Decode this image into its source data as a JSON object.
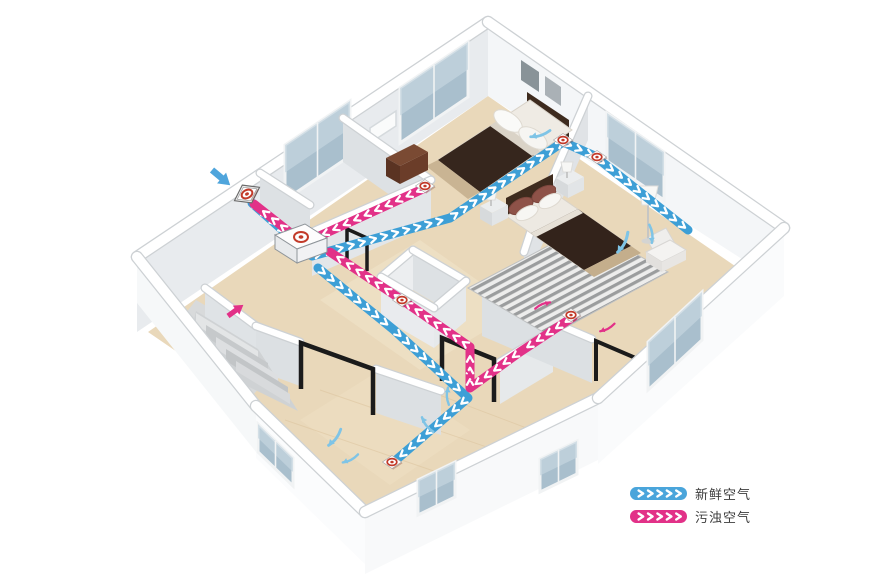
{
  "legend": {
    "items": [
      {
        "id": "fresh-air",
        "label": "新鲜空气",
        "color": "#4AA5DB"
      },
      {
        "id": "stale-air",
        "label": "污浊空气",
        "color": "#E23188"
      }
    ]
  },
  "diagram": {
    "colors": {
      "fresh": "#3D9FD6",
      "stale": "#E23188",
      "room_air": "#7FC4E6",
      "vent_red": "#C23B2A"
    },
    "unit": {
      "id": "heat-recovery-unit",
      "x": 297,
      "y": 245
    },
    "ducts": [
      {
        "id": "duct-fresh-intake",
        "type": "fresh",
        "points": [
          [
            252,
            203
          ],
          [
            297,
            243
          ]
        ]
      },
      {
        "id": "duct-fresh-trunk-bedrooms",
        "type": "fresh",
        "points": [
          [
            312,
            256
          ],
          [
            450,
            218
          ],
          [
            563,
            142
          ]
        ]
      },
      {
        "id": "duct-fresh-bed1-to-bed2",
        "type": "fresh",
        "points": [
          [
            563,
            142
          ],
          [
            597,
            157
          ]
        ]
      },
      {
        "id": "duct-fresh-bedroom2-run",
        "type": "fresh",
        "points": [
          [
            597,
            158
          ],
          [
            688,
            230
          ]
        ]
      },
      {
        "id": "duct-fresh-living-run",
        "type": "fresh",
        "points": [
          [
            318,
            268
          ],
          [
            394,
            330
          ],
          [
            468,
            398
          ],
          [
            396,
            460
          ]
        ]
      },
      {
        "id": "duct-stale-to-outside",
        "type": "stale",
        "points": [
          [
            297,
            238
          ],
          [
            254,
            204
          ]
        ]
      },
      {
        "id": "duct-stale-bedroom1-run",
        "type": "stale",
        "points": [
          [
            425,
            188
          ],
          [
            315,
            238
          ]
        ]
      },
      {
        "id": "duct-stale-trunk",
        "type": "stale",
        "points": [
          [
            573,
            317
          ],
          [
            520,
            352
          ],
          [
            470,
            388
          ],
          [
            470,
            347
          ],
          [
            402,
            300
          ],
          [
            330,
            252
          ]
        ]
      }
    ],
    "vents": [
      {
        "id": "outdoor-wall-vent",
        "x": 247,
        "y": 194,
        "kind": "wall"
      },
      {
        "id": "bedroom1-supply-vent",
        "x": 563,
        "y": 140,
        "kind": "supply"
      },
      {
        "id": "bedroom2-supply-vent",
        "x": 597,
        "y": 157,
        "kind": "supply"
      },
      {
        "id": "bedroom1-extract-vent",
        "x": 425,
        "y": 186,
        "kind": "extract"
      },
      {
        "id": "bedroom2-extract-vent",
        "x": 571,
        "y": 315,
        "kind": "extract"
      },
      {
        "id": "living-supply-vent",
        "x": 392,
        "y": 462,
        "kind": "supply"
      },
      {
        "id": "hallway-extract-vent",
        "x": 402,
        "y": 300,
        "kind": "extract"
      }
    ],
    "arrows": [
      {
        "id": "outdoor-fresh-arrow",
        "style": "straight",
        "x": 212,
        "y": 170,
        "angle": 40,
        "scale": 1.25,
        "color": "#4FA5DC"
      },
      {
        "id": "stairs-exhaust-arrow",
        "style": "straight",
        "x": 228,
        "y": 316,
        "angle": -36,
        "scale": 1.0,
        "color": "#E23188"
      },
      {
        "id": "bedroom1-airflow-arrow",
        "style": "curved",
        "x": 540,
        "y": 133,
        "angle": 195,
        "scale": 1.0,
        "color": "#7FC4E6"
      },
      {
        "id": "bedroom2-airflow-arrow-1",
        "style": "curved",
        "x": 622,
        "y": 242,
        "angle": 150,
        "scale": 1.1,
        "color": "#7FC4E6"
      },
      {
        "id": "bedroom2-airflow-arrow-2",
        "style": "curved",
        "x": 650,
        "y": 234,
        "angle": 115,
        "scale": 0.9,
        "color": "#7FC4E6"
      },
      {
        "id": "living-airflow-arrow-1",
        "style": "curved",
        "x": 334,
        "y": 437,
        "angle": 160,
        "scale": 1.0,
        "color": "#7FC4E6"
      },
      {
        "id": "living-airflow-arrow-2",
        "style": "curved",
        "x": 350,
        "y": 458,
        "angle": 185,
        "scale": 0.85,
        "color": "#7FC4E6"
      },
      {
        "id": "living-airflow-arrow-3",
        "style": "curved",
        "x": 428,
        "y": 424,
        "angle": -95,
        "scale": 0.9,
        "color": "#7FC4E6"
      },
      {
        "id": "living-airflow-arrow-4",
        "style": "curved",
        "x": 449,
        "y": 396,
        "angle": -60,
        "scale": 0.85,
        "color": "#7FC4E6"
      },
      {
        "id": "bedroom2-extract-arrow-left",
        "style": "curved",
        "x": 543,
        "y": 306,
        "angle": 10,
        "scale": 0.8,
        "color": "#E23188"
      },
      {
        "id": "bedroom2-extract-arrow-right",
        "style": "curved",
        "x": 607,
        "y": 327,
        "angle": 185,
        "scale": 0.8,
        "color": "#E23188"
      },
      {
        "id": "duct-drop-arrow",
        "style": "curved",
        "x": 470,
        "y": 377,
        "angle": 90,
        "scale": 0.7,
        "color": "#E23188"
      }
    ]
  }
}
